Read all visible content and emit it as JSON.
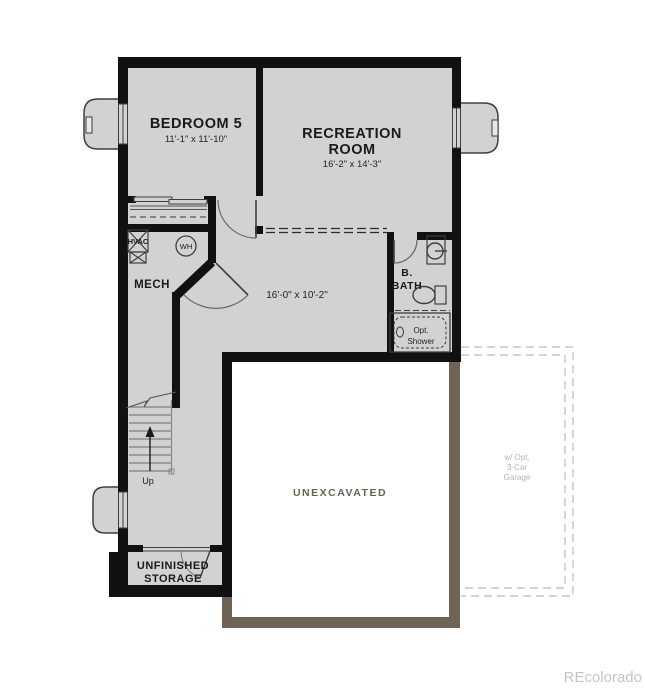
{
  "colors": {
    "floor": "#d2d2d2",
    "wall": "#111111",
    "fixture_line": "#3f3f3f",
    "unexcavated_border": "#6e6354",
    "unexcavated_text": "#6b6054",
    "garage_dash": "#c6c6c6",
    "garage_text": "#b5b5b5",
    "watermark_text": "#c5c5c5",
    "background": "#ffffff"
  },
  "rooms": {
    "bedroom5": {
      "name": "BEDROOM 5",
      "dims": "11'-1\" x 11'-10\""
    },
    "recreation": {
      "name_line1": "RECREATION",
      "name_line2": "ROOM",
      "dims": "16'-2\" x 14'-3\""
    },
    "mech": {
      "name": "MECH"
    },
    "bath": {
      "name_line1": "B.",
      "name_line2": "BATH"
    },
    "hall": {
      "dims": "16'-0\" x 10'-2\""
    },
    "storage": {
      "name_line1": "UNFINISHED",
      "name_line2": "STORAGE"
    },
    "unexcavated": {
      "name": "UNEXCAVATED"
    },
    "garage_option": {
      "line1": "w/ Opt.",
      "line2": "3-Car",
      "line3": "Garage"
    }
  },
  "fixtures": {
    "hvac_label": "HVAC",
    "water_heater_label": "WH",
    "shower_line1": "Opt.",
    "shower_line2": "Shower"
  },
  "stairs": {
    "label": "Up"
  },
  "watermark": "REcolorado"
}
